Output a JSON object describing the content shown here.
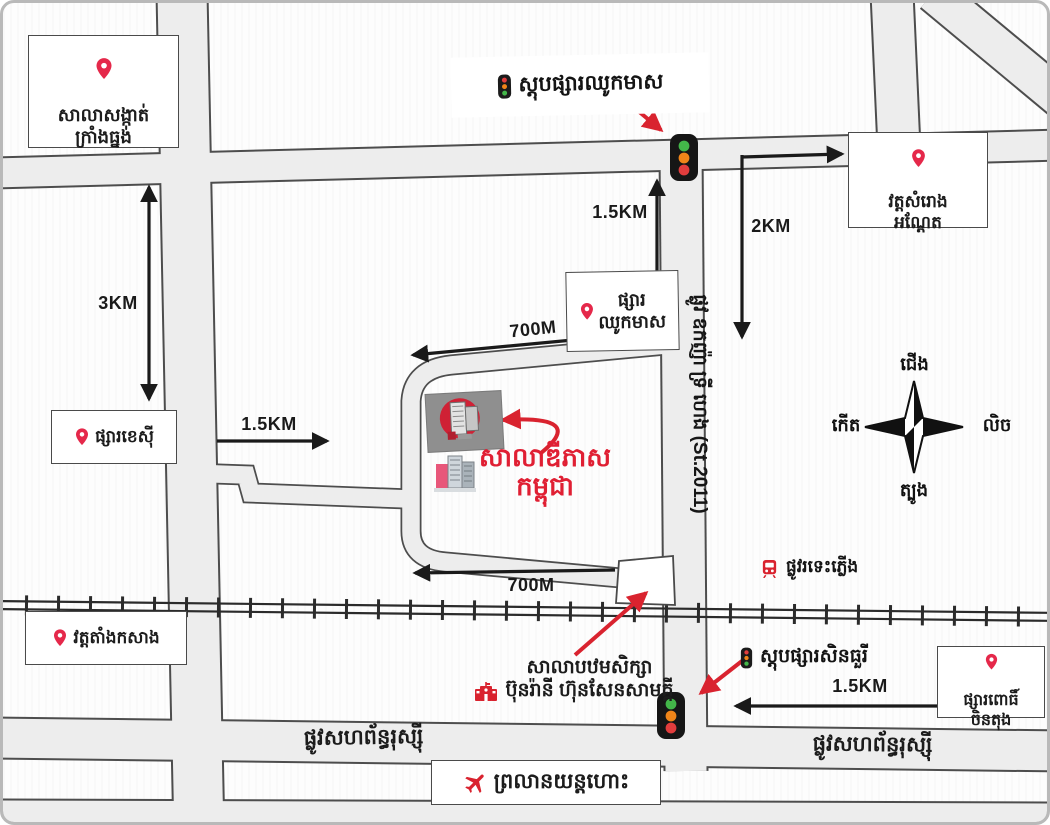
{
  "labels": {
    "commune_office": "សាលាសង្កាត់\nក្រាំងធ្នង់",
    "stop_chhouk_meas": "ស្តុបផ្សារឈូកមាស",
    "wat_samrong_andet": "វត្តសំរោង\nអណ្ដែត",
    "market_chhouk_meas": "ផ្សារ\nឈូកមាស",
    "market_kaysi": "ផ្សារខេស៊ី",
    "dipas_school": "សាលាឌីភាស\nកម្ពុជា",
    "street_2011": "ផ្លូវ ឧកញ៉ា ទ្រី ហេង (St.2011)",
    "wat_tang_kasang": "វត្តតាំងកសាង",
    "primary_school": "សាលាបឋមសិក្សា\nប៊ុនរ៉ានី ហ៊ុនសែនសាមគ្គី",
    "stop_sinthury": "ស្តុបផ្សារសិនធួរី",
    "railway_road": "ផ្លូវរទេះភ្លើង",
    "market_pochentong": "ផ្សារពោធិ៍\nចិនតុង",
    "russian_blvd_west": "ផ្លូវសហព័ន្ធរុស្ស៊ី",
    "russian_blvd_east": "ផ្លូវសហព័ន្ធរុស្ស៊ី",
    "airport": "ព្រលានយន្តហោះ"
  },
  "distances": {
    "left_vertical": "3KM",
    "top_vertical": "1.5KM",
    "top_horizontal": "700M",
    "west_access": "1.5KM",
    "east_vertical": "2KM",
    "bottom_horizontal": "700M",
    "southeast": "1.5KM"
  },
  "compass": {
    "north": "ជើង",
    "south": "ត្បូង",
    "east": "កើត",
    "west": "លិច"
  },
  "colors": {
    "accent_red": "#e01f33",
    "pin": "#e5284a",
    "road_fill": "#ededed",
    "road_casing": "#4d4d4d",
    "traffic_green": "#43b649",
    "traffic_orange": "#f08519",
    "traffic_red": "#e23d3d"
  }
}
